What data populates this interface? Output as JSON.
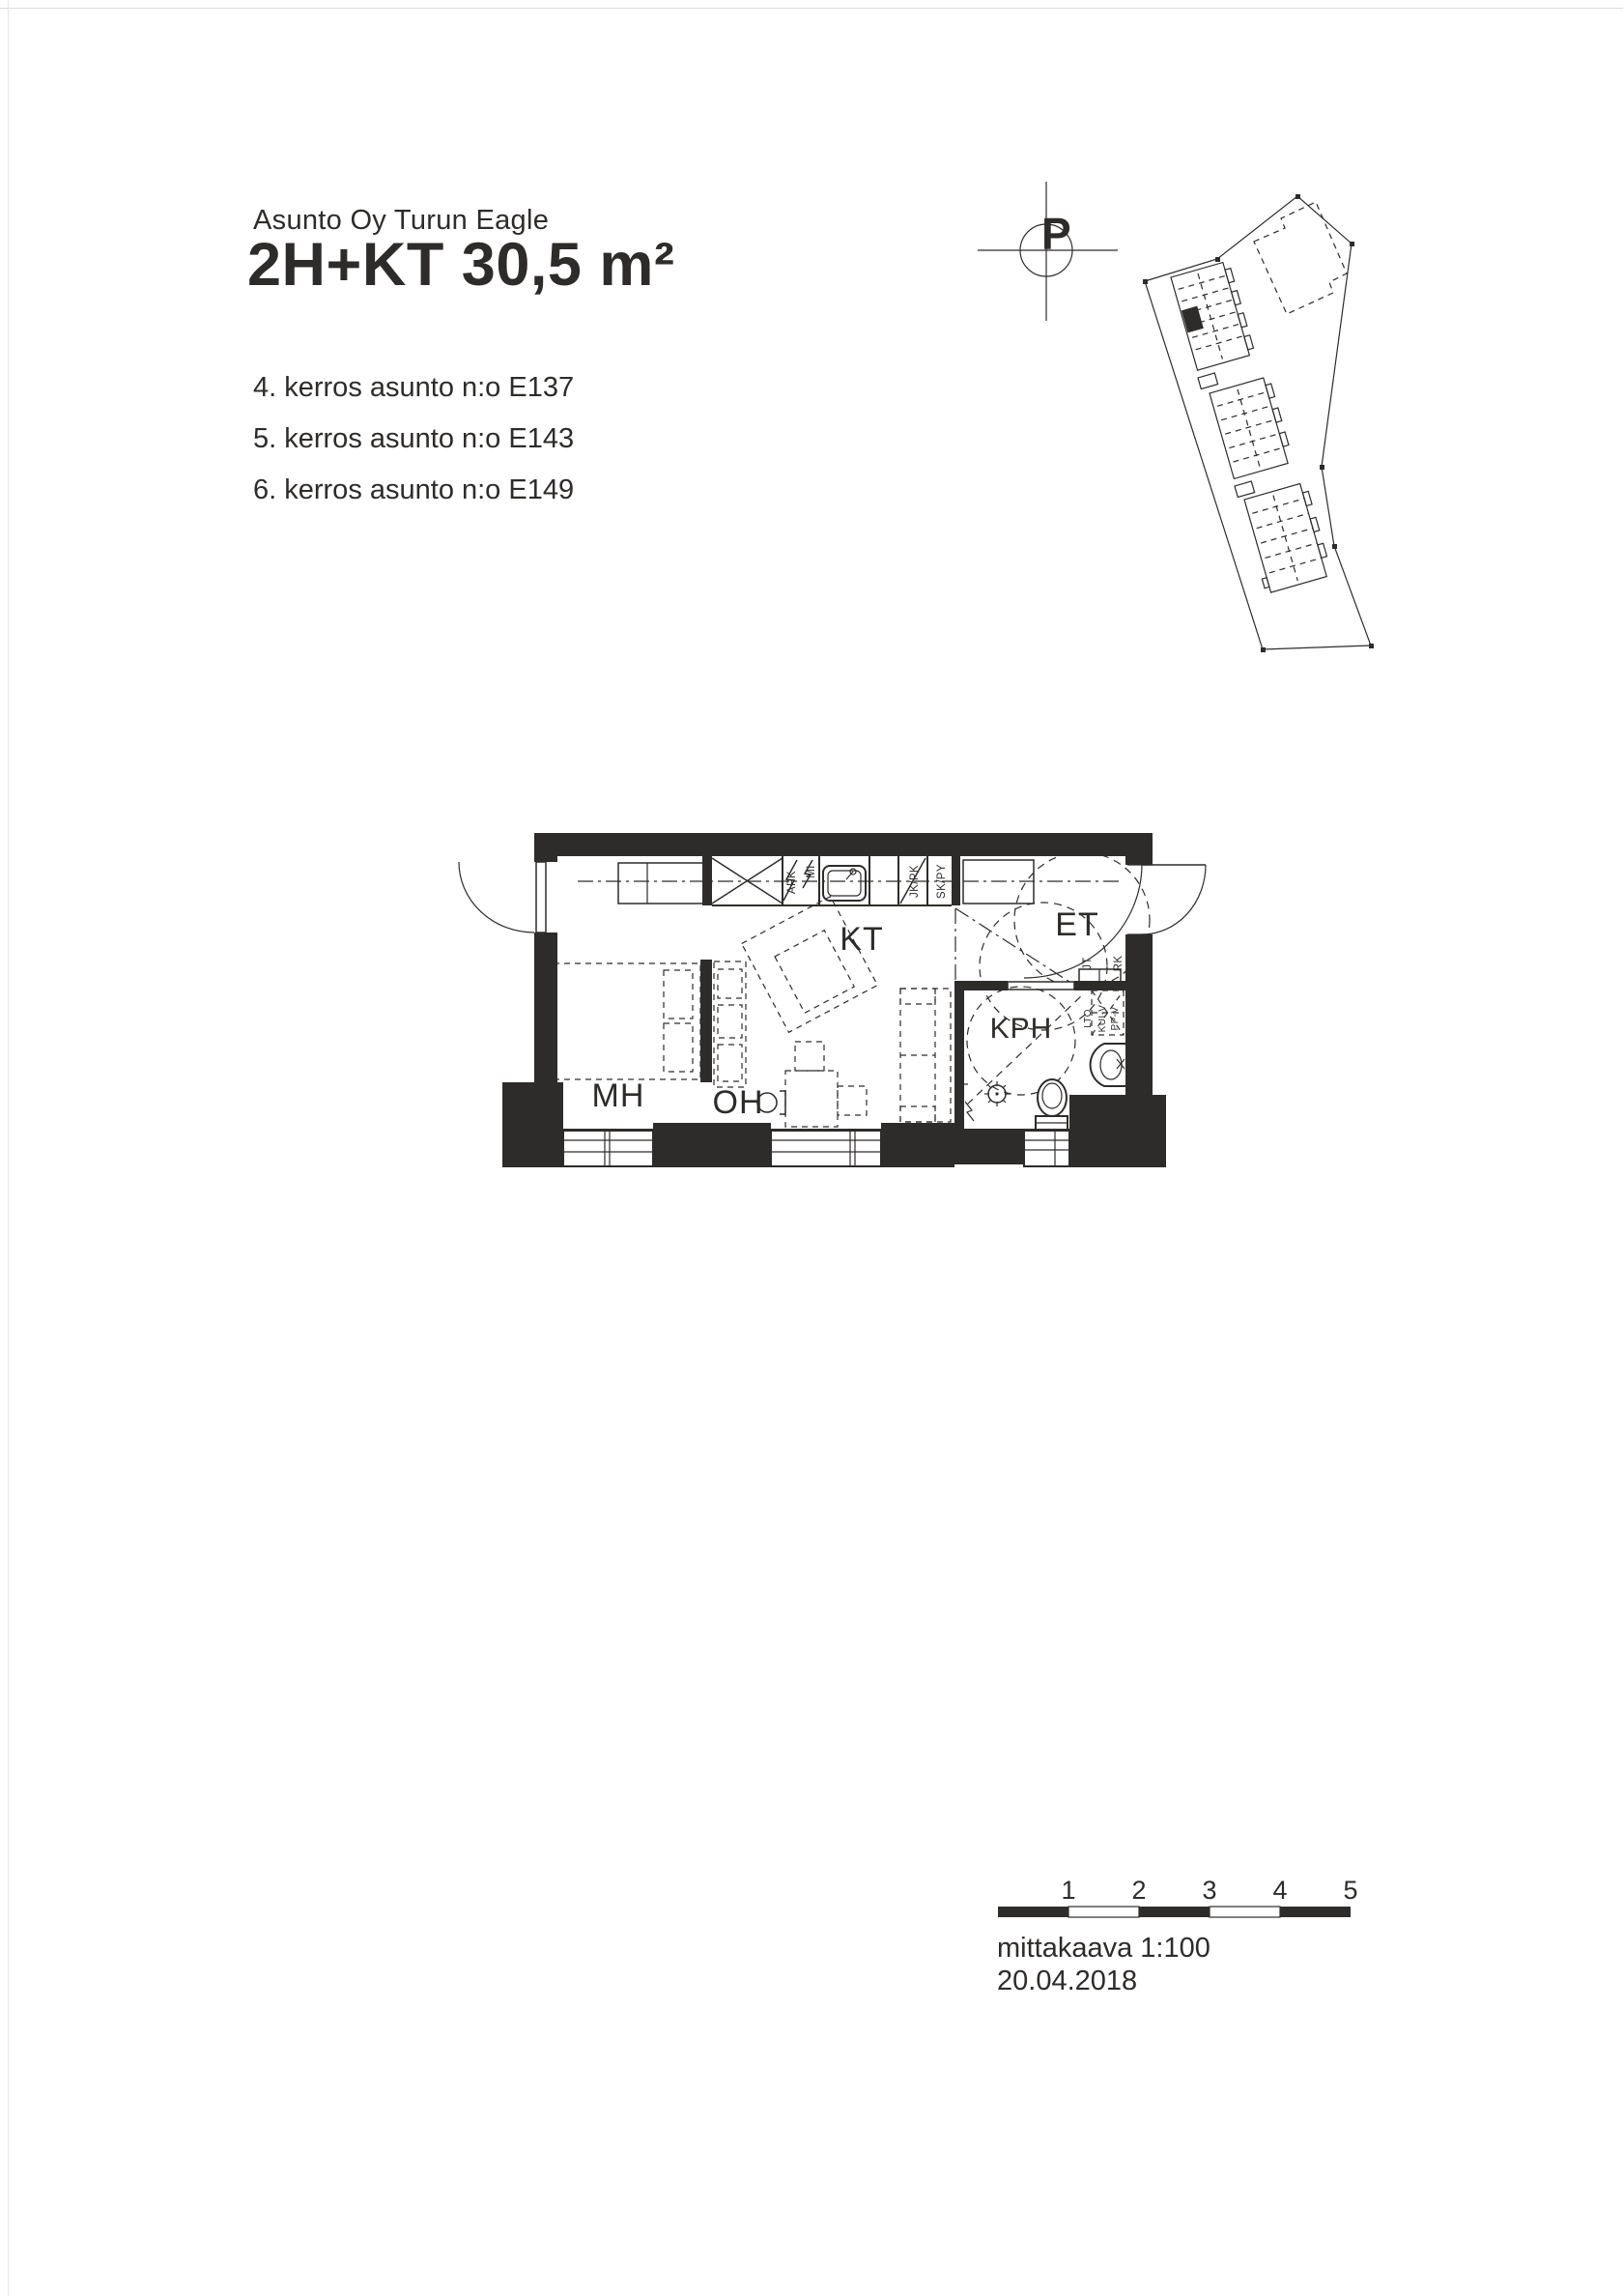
{
  "header": {
    "company": "Asunto Oy Turun Eagle",
    "title": "2H+KT 30,5 m²",
    "apartments": [
      "4. kerros asunto n:o E137",
      "5. kerros asunto n:o E143",
      "6. kerros asunto n:o E149"
    ]
  },
  "compass": {
    "north_letter": "P"
  },
  "floor_plan": {
    "room_labels": {
      "kt": "KT",
      "et": "ET",
      "kph": "KPH",
      "mh": "MH",
      "oh": "OH"
    },
    "fixture_labels": {
      "apk": "APK",
      "mi": "MI",
      "jk_pk": "JK/PK",
      "sk_py": "SK/PY",
      "jt": "JT",
      "rk": "RK",
      "lto": "LTO",
      "kui_v": "KUI-V",
      "pp_v": "PP-V"
    }
  },
  "scale_bar": {
    "ticks": [
      "1",
      "2",
      "3",
      "4",
      "5"
    ],
    "scale_label": "mittakaava 1:100",
    "date": "20.04.2018"
  },
  "colors": {
    "ink": "#2e2c2a",
    "paper": "#ffffff"
  }
}
